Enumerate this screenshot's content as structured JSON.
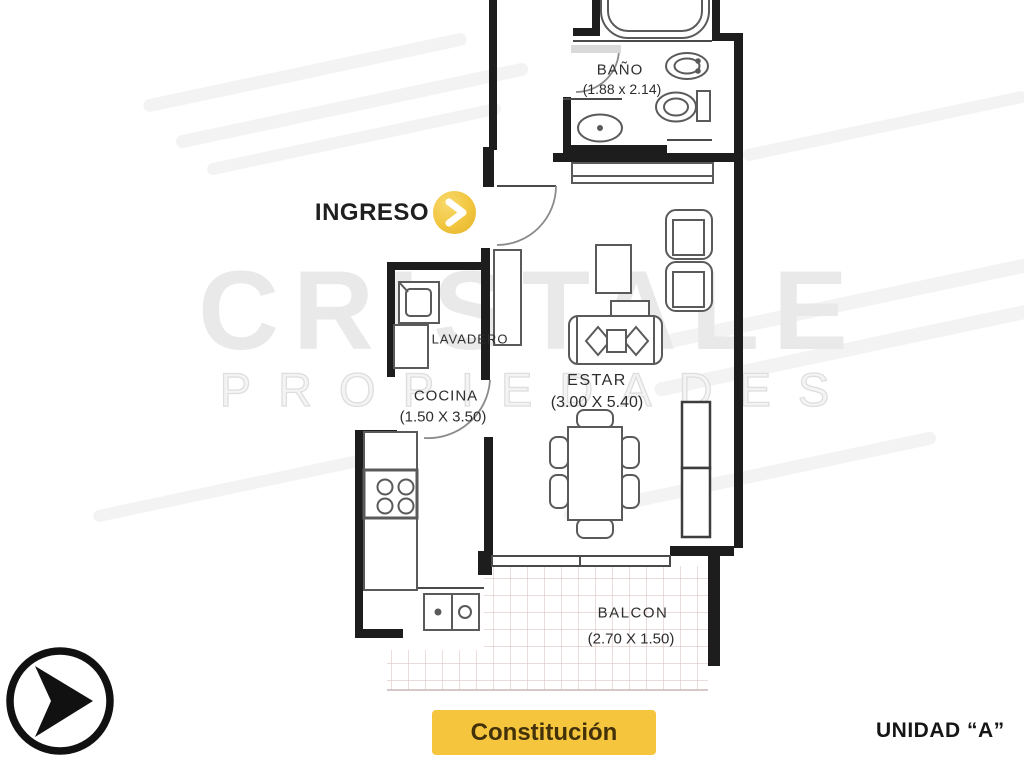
{
  "watermark": {
    "line1": "CRISTALE",
    "line2": "PROPIEDADES"
  },
  "entry": {
    "label": "INGRESO",
    "arrow_icon": "chevron-right-icon"
  },
  "rooms": {
    "bano": {
      "name": "BAÑO",
      "dims": "(1.88 x 2.14)"
    },
    "lavadero": {
      "name": "LAVADERO"
    },
    "cocina": {
      "name": "COCINA",
      "dims": "(1.50 X 3.50)"
    },
    "estar": {
      "name": "ESTAR",
      "dims": "(3.00 X 5.40)"
    },
    "balcon": {
      "name": "BALCON",
      "dims": "(2.70 X 1.50)"
    }
  },
  "footer": {
    "location_label": "Constitución",
    "unit_label": "UNIDAD “A”"
  },
  "colors": {
    "accent_yellow": "#F5C63D",
    "button_text": "#43310A",
    "wall": "#1D1D1D",
    "fixture_line": "#5A5A5A",
    "balcony_grid": "#DFC6C6",
    "watermark_gray": "#E9E9E9"
  },
  "icons": {
    "logo": "arrow-right-circle-icon"
  }
}
